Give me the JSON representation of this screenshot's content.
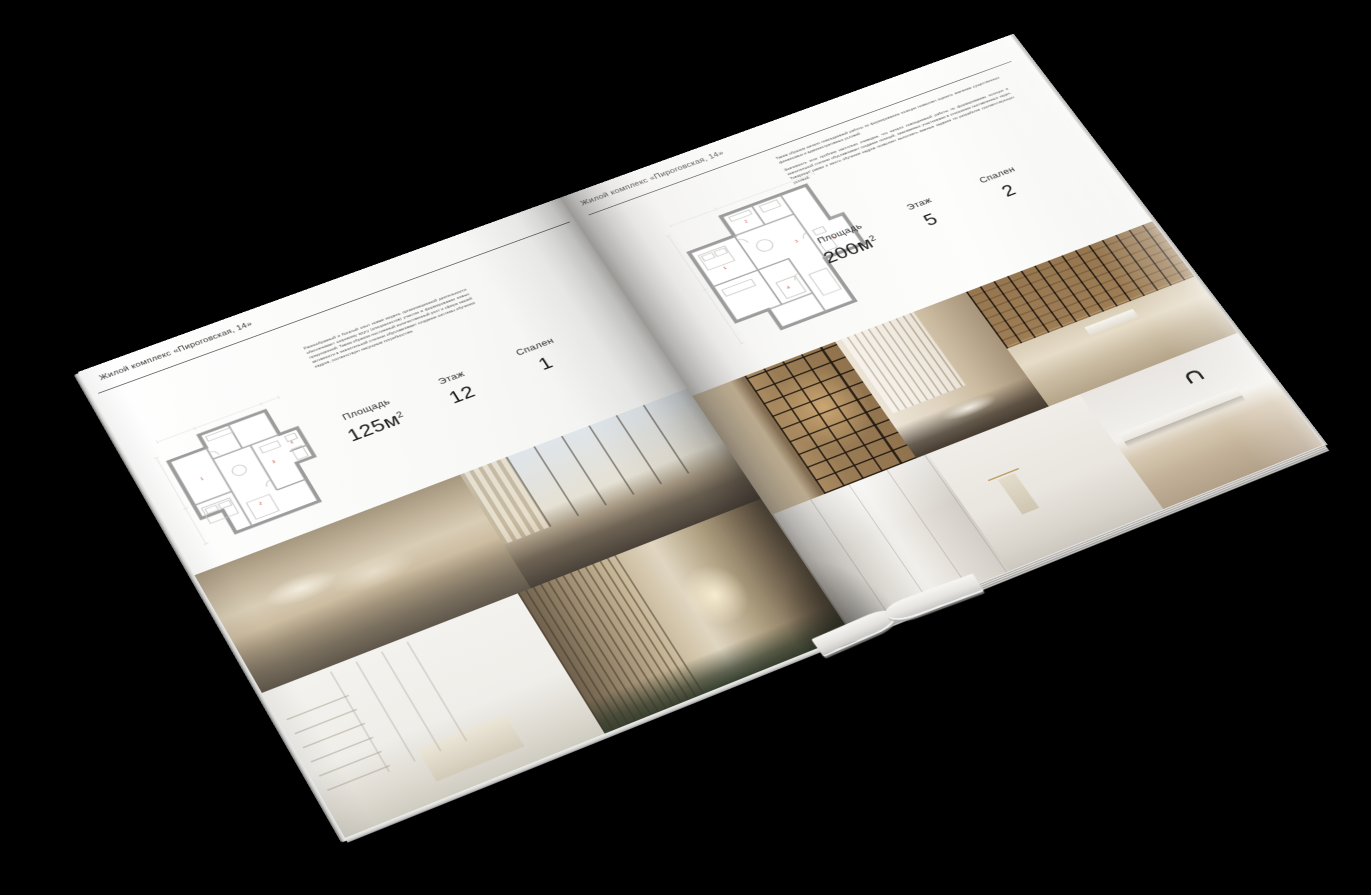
{
  "scene": {
    "background": "#000000",
    "paper_color": "#f6f5f2",
    "plan_marker_color": "#c0392b"
  },
  "brochure": {
    "header_title": "Жилой комплекс «Пироговская, 14»",
    "left_page": {
      "description": "Разнообразный и богатый опыт новая модель организационной деятельности обеспечивает широкому кругу (специалистов) участие в формировании новых предложений. Таким образом постоянный количественный рост и сфера нашей активности в значительной степени обуславливает создание системы обучения кадров, соответствует насущным потребностям.",
      "stats": [
        {
          "label": "Площадь",
          "value": "125м",
          "sup": "2"
        },
        {
          "label": "Этаж",
          "value": "12",
          "sup": ""
        },
        {
          "label": "Спален",
          "value": "1",
          "sup": ""
        }
      ],
      "plan_markers": [
        "1",
        "2",
        "3",
        "4"
      ],
      "photos": [
        "bedroom-suite",
        "living-room-panorama",
        "white-bedroom",
        "hallway-dressing-room"
      ]
    },
    "right_page": {
      "description_p1": "Таким образом начало повседневной работы по формированию позиции позволяет оценить значение существенных финансовых и административных условий.",
      "description_p2": "Значимость этих проблем настолько очевидна, что начало повседневной работы по формированию позиции в значительной степени обуславливает создание позиций, занимаемых участниками в отношении поставленных задач. Товарищи! рамки и место обучения кадров позволяет выполнять важные задания по разработке соответствующих условий.",
      "stats": [
        {
          "label": "Площадь",
          "value": "200м",
          "sup": "2"
        },
        {
          "label": "Этаж",
          "value": "5",
          "sup": ""
        },
        {
          "label": "Спален",
          "value": "2",
          "sup": ""
        }
      ],
      "plan_markers": [
        "1",
        "2",
        "3",
        "4",
        "5"
      ],
      "photos": [
        "wardrobe-showcase",
        "dressing-room",
        "study-library",
        "bathroom-panels",
        "bathroom-towel",
        "bathroom-vanity"
      ]
    }
  }
}
